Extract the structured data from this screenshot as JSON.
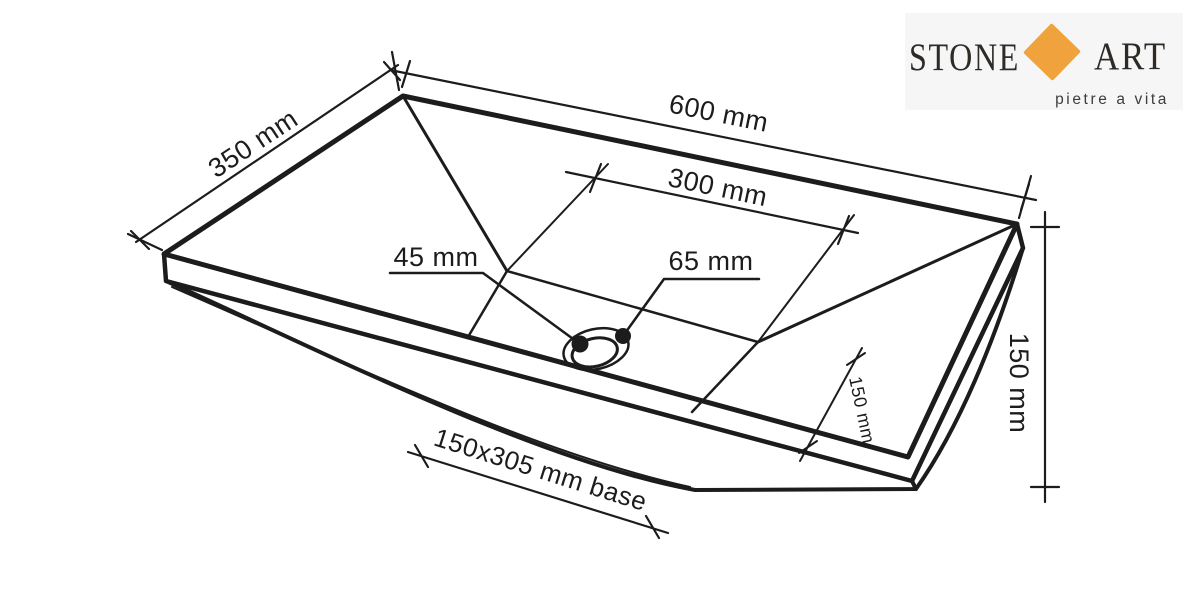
{
  "page": {
    "background": "#ffffff"
  },
  "logo": {
    "brand_left": "STONE",
    "brand_right": "ART",
    "tagline": "pietre a vita",
    "colors": {
      "background": "#f6f6f6",
      "diamond": "#F0A33C",
      "text": "#2E2A26",
      "tagline_text": "#3C3C3A"
    }
  },
  "drawing": {
    "labels": {
      "top_width": "600 mm",
      "left_depth": "350 mm",
      "inner_width": "300 mm",
      "drain_hole": "45 mm",
      "drain_flange": "65 mm",
      "drain_offset": "150 mm",
      "height": "150 mm",
      "base": "150x305 mm base"
    },
    "colors": {
      "line": "#1C1C1C",
      "top_face": "#D2D2D2",
      "side_face": "#E9E9E9",
      "rim_face": "#FFFFFF",
      "drain_ring": "#D8D8D8",
      "drain_hole": "#C6C6C6"
    }
  }
}
